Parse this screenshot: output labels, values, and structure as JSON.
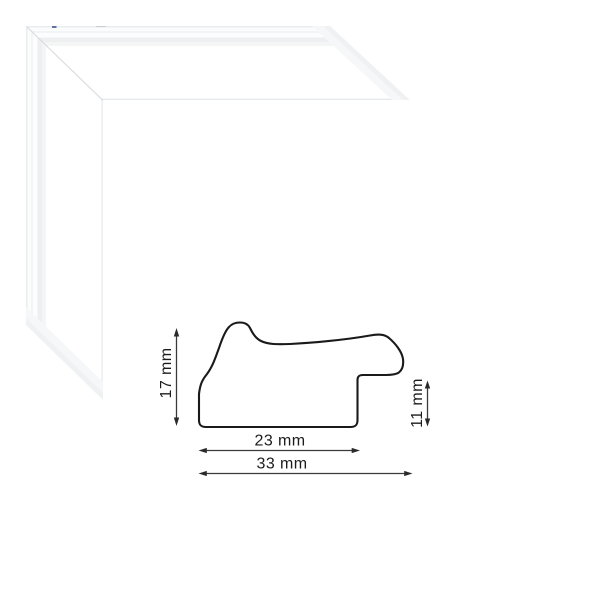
{
  "page": {
    "background": "#ffffff"
  },
  "frame_sample": {
    "kind": "white picture frame corner sample",
    "colors": {
      "surface": "#ffffff",
      "edge_line": "#e9edef",
      "groove_band": "#edeff0",
      "miter_line": "#d7dbde",
      "inner_shadow": "#e7eaec"
    }
  },
  "diagram": {
    "title": "moulding cross-section with dimensions",
    "outline_color": "#1a1a1a",
    "dimension_color": "#333333",
    "dimensions": {
      "height_label": "17 mm",
      "rabbet_label": "11 mm",
      "face_label": "23 mm",
      "width_label": "33 mm"
    }
  }
}
